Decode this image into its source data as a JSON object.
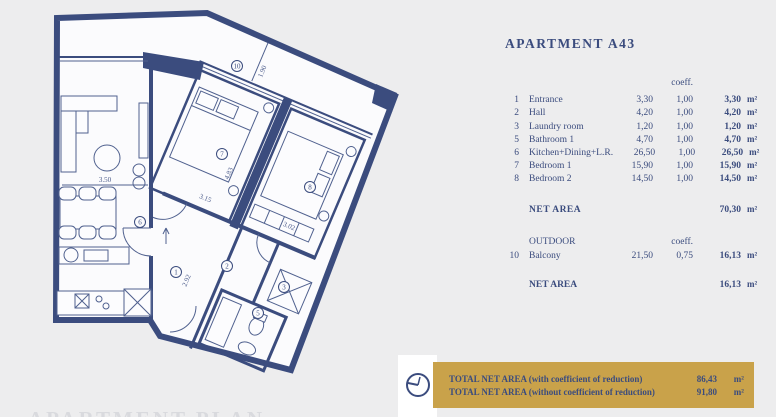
{
  "page": {
    "bg": "#ededee",
    "accent_navy": "#3b4c7e",
    "accent_gold": "#c9a24a"
  },
  "apartment_table": {
    "title": "APARTMENT A43",
    "coeff_header": "coeff.",
    "unit": "m²",
    "rows": [
      {
        "num": "1",
        "name": "Entrance",
        "area": "3,30",
        "coeff": "1,00",
        "net": "3,30"
      },
      {
        "num": "2",
        "name": "Hall",
        "area": "4,20",
        "coeff": "1,00",
        "net": "4,20"
      },
      {
        "num": "3",
        "name": "Laundry room",
        "area": "1,20",
        "coeff": "1,00",
        "net": "1,20"
      },
      {
        "num": "5",
        "name": "Bathroom 1",
        "area": "4,70",
        "coeff": "1,00",
        "net": "4,70"
      },
      {
        "num": "6",
        "name": "Kitchen+Dining+L.R.",
        "area": "26,50",
        "coeff": "1,00",
        "net": "26,50"
      },
      {
        "num": "7",
        "name": "Bedroom 1",
        "area": "15,90",
        "coeff": "1,00",
        "net": "15,90"
      },
      {
        "num": "8",
        "name": "Bedroom 2",
        "area": "14,50",
        "coeff": "1,00",
        "net": "14,50"
      }
    ],
    "net_area_label": "NET AREA",
    "net_area_value": "70,30",
    "outdoor_header": "OUTDOOR",
    "outdoor_coeff_header": "coeff.",
    "outdoor_rows": [
      {
        "num": "10",
        "name": "Balcony",
        "area": "21,50",
        "coeff": "0,75",
        "net": "16,13"
      }
    ],
    "outdoor_net_area_label": "NET AREA",
    "outdoor_net_area_value": "16,13"
  },
  "totals": {
    "line1_label": "TOTAL NET AREA (with coefficient of reduction)",
    "line1_value": "86,43",
    "line2_label": "TOTAL NET AREA (without coefficient of reduction)",
    "line2_value": "91,80",
    "unit": "m²"
  },
  "floor_plan": {
    "caption": "APARTMENT PLAN",
    "room_labels": [
      {
        "num": "10",
        "room": "balcony"
      },
      {
        "num": "6",
        "room": "kitchen-dining-living"
      },
      {
        "num": "7",
        "room": "bedroom-1"
      },
      {
        "num": "8",
        "room": "bedroom-2"
      },
      {
        "num": "1",
        "room": "entrance"
      },
      {
        "num": "2",
        "room": "hall"
      },
      {
        "num": "3",
        "room": "laundry"
      },
      {
        "num": "5",
        "room": "bathroom-1"
      }
    ],
    "dimensions": [
      {
        "text": "3.50"
      },
      {
        "text": "1.90"
      },
      {
        "text": "4.83"
      },
      {
        "text": "3.15"
      },
      {
        "text": "3.02"
      },
      {
        "text": "2.92"
      }
    ]
  }
}
